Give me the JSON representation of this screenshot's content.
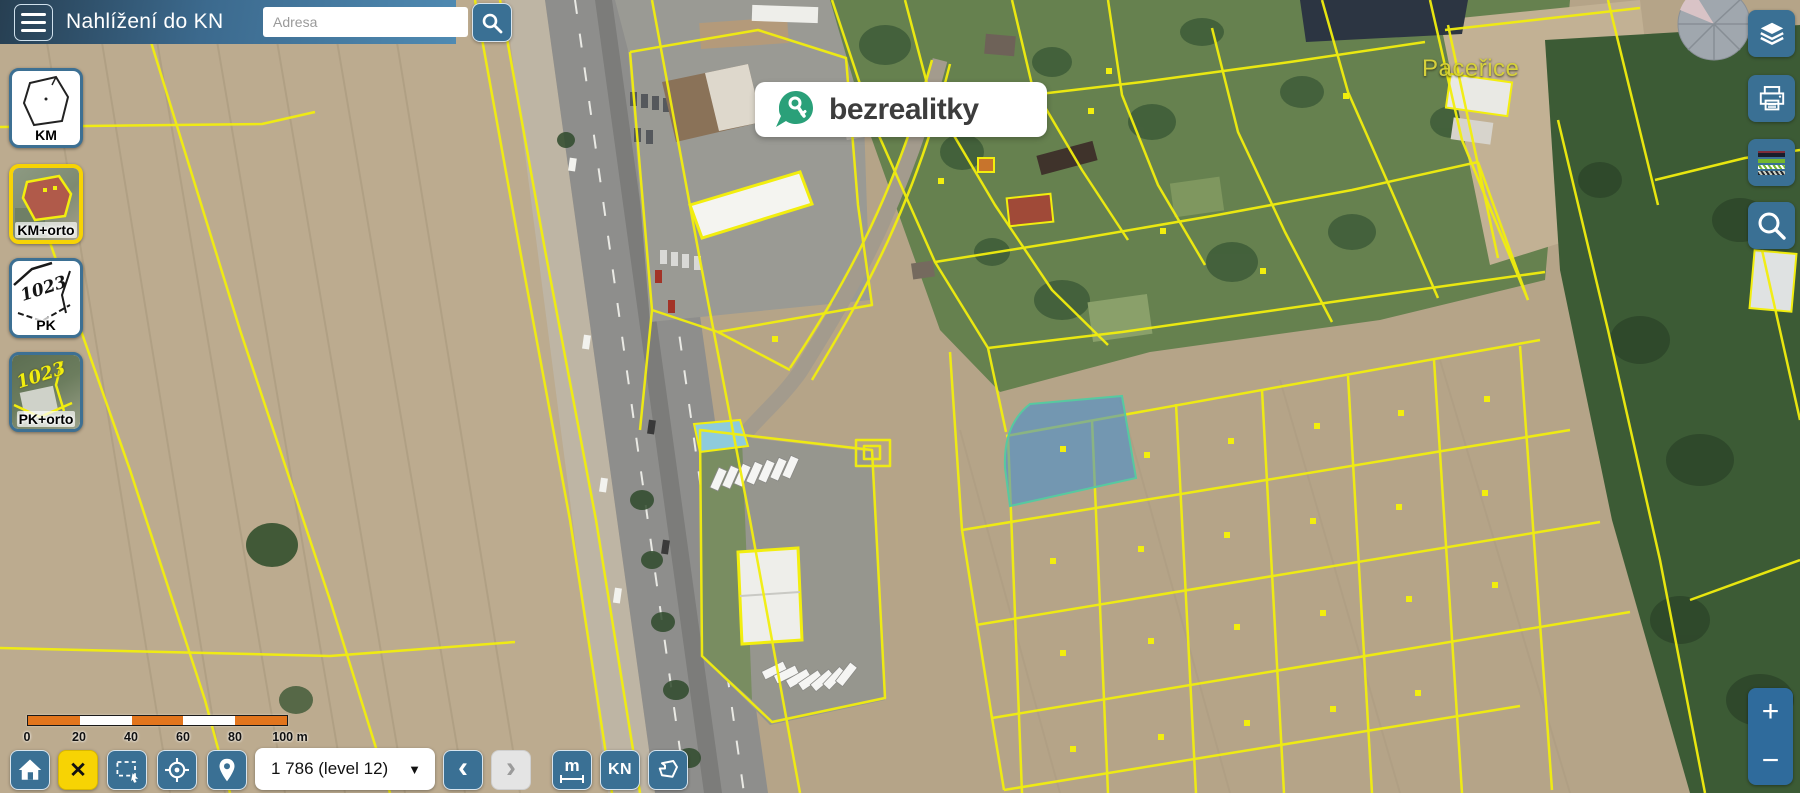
{
  "header": {
    "title": "Nahlížení do KN",
    "search_placeholder": "Adresa"
  },
  "layers_panel": {
    "items": [
      {
        "label": "KM",
        "selected": false,
        "thumb_text": ""
      },
      {
        "label": "KM+orto",
        "selected": true,
        "thumb_text": ""
      },
      {
        "label": "PK",
        "selected": false,
        "thumb_text": "1023"
      },
      {
        "label": "PK+orto",
        "selected": false,
        "thumb_text": "1023"
      }
    ]
  },
  "right_toolbar": {
    "icons": [
      "layers-icon",
      "printer-icon",
      "legend-icon",
      "search-icon"
    ]
  },
  "map": {
    "place_label": "Paceřice",
    "watermark_text": "bezrealitky",
    "highlighted_parcel": "blue semi-transparent parcel polygon"
  },
  "scale_bar": {
    "labels": [
      "0",
      "20",
      "40",
      "60",
      "80"
    ],
    "end_label": "100 m"
  },
  "bottom_toolbar": {
    "close_glyph": "✕",
    "zoom_select_value": "1 786 (level 12)",
    "dropdown_caret": "▼",
    "back_glyph": "‹",
    "forward_glyph": "›",
    "measure_label": "m",
    "kn_label": "KN"
  },
  "zoom_control": {
    "plus": "+",
    "minus": "−"
  },
  "colors": {
    "header_blue_dark": "#273f52",
    "header_blue": "#4f8ab2",
    "button_blue": "#3a7094",
    "active_yellow": "#f7d304",
    "parcel_yellow": "#f2ee0e",
    "scale_orange": "#e2751d",
    "highlight_blue": "#4890cd",
    "logo_green": "#2aa079"
  }
}
